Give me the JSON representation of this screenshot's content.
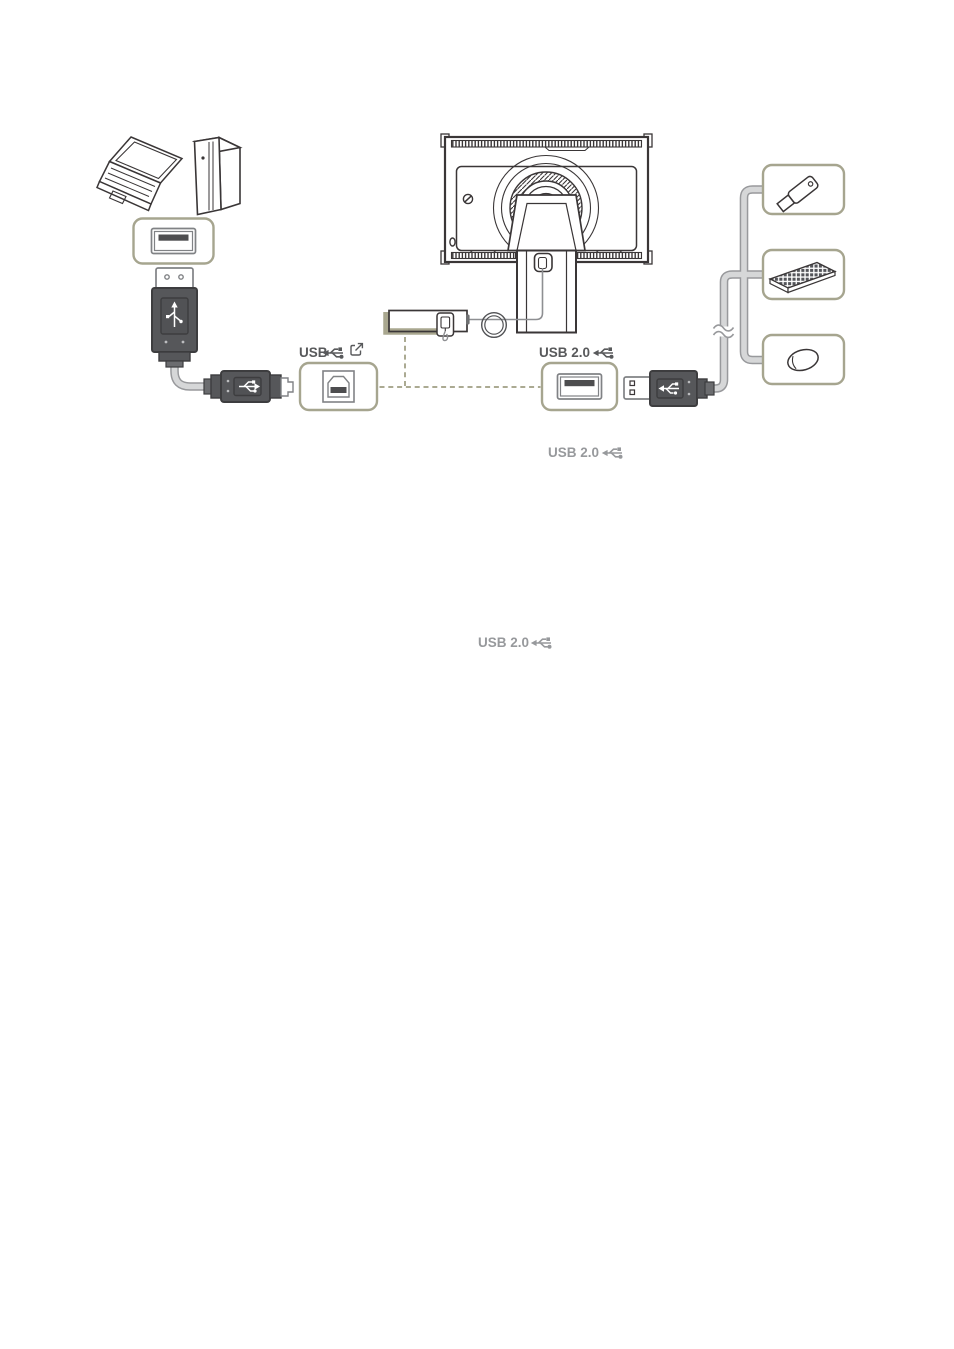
{
  "page": {
    "background_color": "#ffffff"
  },
  "labels": {
    "usb_upstream_port": "USB",
    "usb_downstream_port": "USB 2.0",
    "usb_connector_caption": "USB 2.0",
    "usb_note_caption": "USB 2.0"
  },
  "colors": {
    "box_border_olive": "#A6A58F",
    "port_highlight_olive": "#A9A78F",
    "dashed_line_olive": "#ABAA92",
    "label_dark_gray": "#58595B",
    "label_light_gray": "#97999C",
    "connector_body_gray": "#56575A",
    "cable_gray": "#D6D7D8",
    "line_art_dark": "#3A3637",
    "port_tongue_dark": "#4D4D4F"
  },
  "icons": {
    "sources": [
      "laptop-icon",
      "desktop-pc-icon"
    ],
    "display": "monitor-rear-icon",
    "ports": [
      "usb-a-port-icon",
      "usb-b-port-icon"
    ],
    "symbols": [
      "usb-trident-icon",
      "upstream-arrow-icon",
      "cable-break-icon"
    ],
    "peripherals": [
      "usb-flash-drive-icon",
      "keyboard-icon",
      "mouse-icon"
    ]
  }
}
